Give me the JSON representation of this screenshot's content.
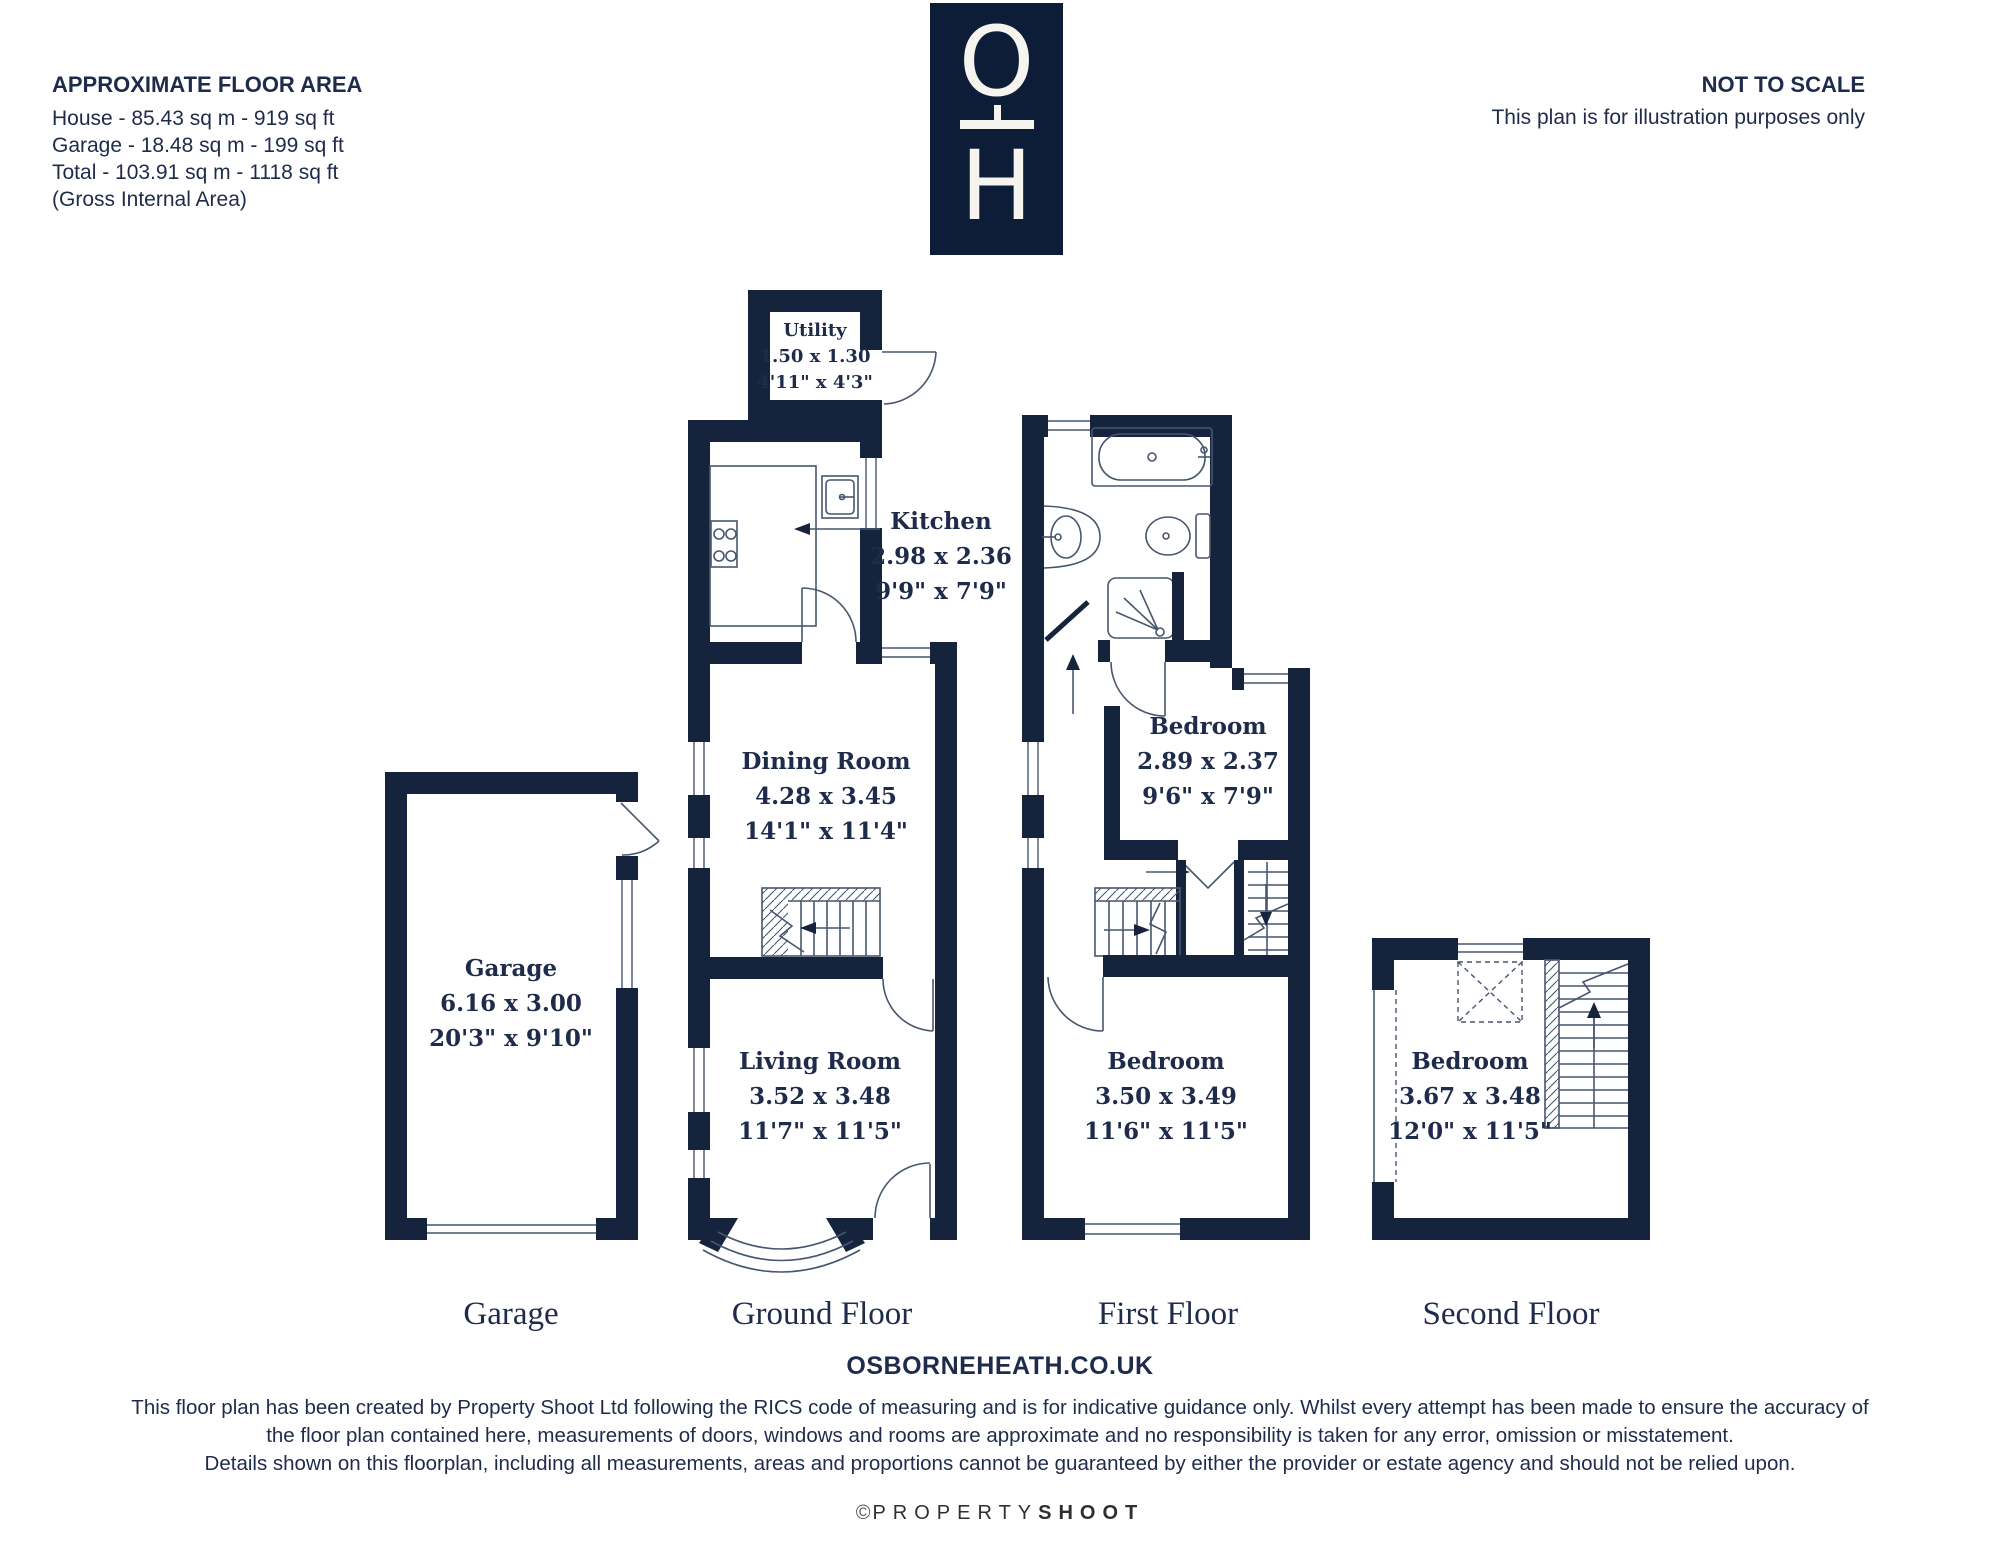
{
  "header": {
    "area_title": "APPROXIMATE FLOOR AREA",
    "area_lines": [
      "House - 85.43 sq m - 919 sq ft",
      "Garage - 18.48 sq m - 199 sq ft",
      "Total - 103.91 sq m - 1118 sq ft",
      "(Gross Internal Area)"
    ],
    "scale_title": "NOT TO SCALE",
    "scale_note": "This plan is for illustration purposes only",
    "logo_top": "O",
    "logo_bottom": "H"
  },
  "rooms": {
    "utility": {
      "name": "Utility",
      "metric": "1.50 x 1.30",
      "imperial": "4'11\" x 4'3\""
    },
    "kitchen": {
      "name": "Kitchen",
      "metric": "2.98 x 2.36",
      "imperial": "9'9\" x 7'9\""
    },
    "dining": {
      "name": "Dining Room",
      "metric": "4.28 x 3.45",
      "imperial": "14'1\" x 11'4\""
    },
    "living": {
      "name": "Living Room",
      "metric": "3.52 x 3.48",
      "imperial": "11'7\" x 11'5\""
    },
    "garage": {
      "name": "Garage",
      "metric": "6.16 x 3.00",
      "imperial": "20'3\" x 9'10\""
    },
    "bedroom_back": {
      "name": "Bedroom",
      "metric": "2.89 x 2.37",
      "imperial": "9'6\" x 7'9\""
    },
    "bedroom_front": {
      "name": "Bedroom",
      "metric": "3.50 x 3.49",
      "imperial": "11'6\" x 11'5\""
    },
    "bedroom_second": {
      "name": "Bedroom",
      "metric": "3.67 x 3.48",
      "imperial": "12'0\" x 11'5\""
    }
  },
  "floor_labels": {
    "garage": "Garage",
    "ground": "Ground Floor",
    "first": "First Floor",
    "second": "Second Floor"
  },
  "footer": {
    "website": "OSBORNEHEATH.CO.UK",
    "disclaimer": [
      "This floor plan has been created by Property Shoot Ltd following the RICS code of measuring and is for indicative guidance only. Whilst every attempt has been made to ensure the accuracy of",
      "the floor plan contained here, measurements of doors, windows and rooms are approximate and no responsibility is taken for any error, omission or misstatement.",
      "Details shown on this floorplan, including all measurements, areas and proportions cannot be guaranteed by either the provider or estate agency and should not be relied upon."
    ],
    "credit_symbol": "©",
    "credit_light": "PROPERTY",
    "credit_bold": "SHOOT"
  },
  "colors": {
    "wall": "#16233d",
    "thin": "#47566f",
    "text": "#1e2b4b",
    "logo_bg": "#0e1d37",
    "logo_fg": "#f6f4ee"
  }
}
